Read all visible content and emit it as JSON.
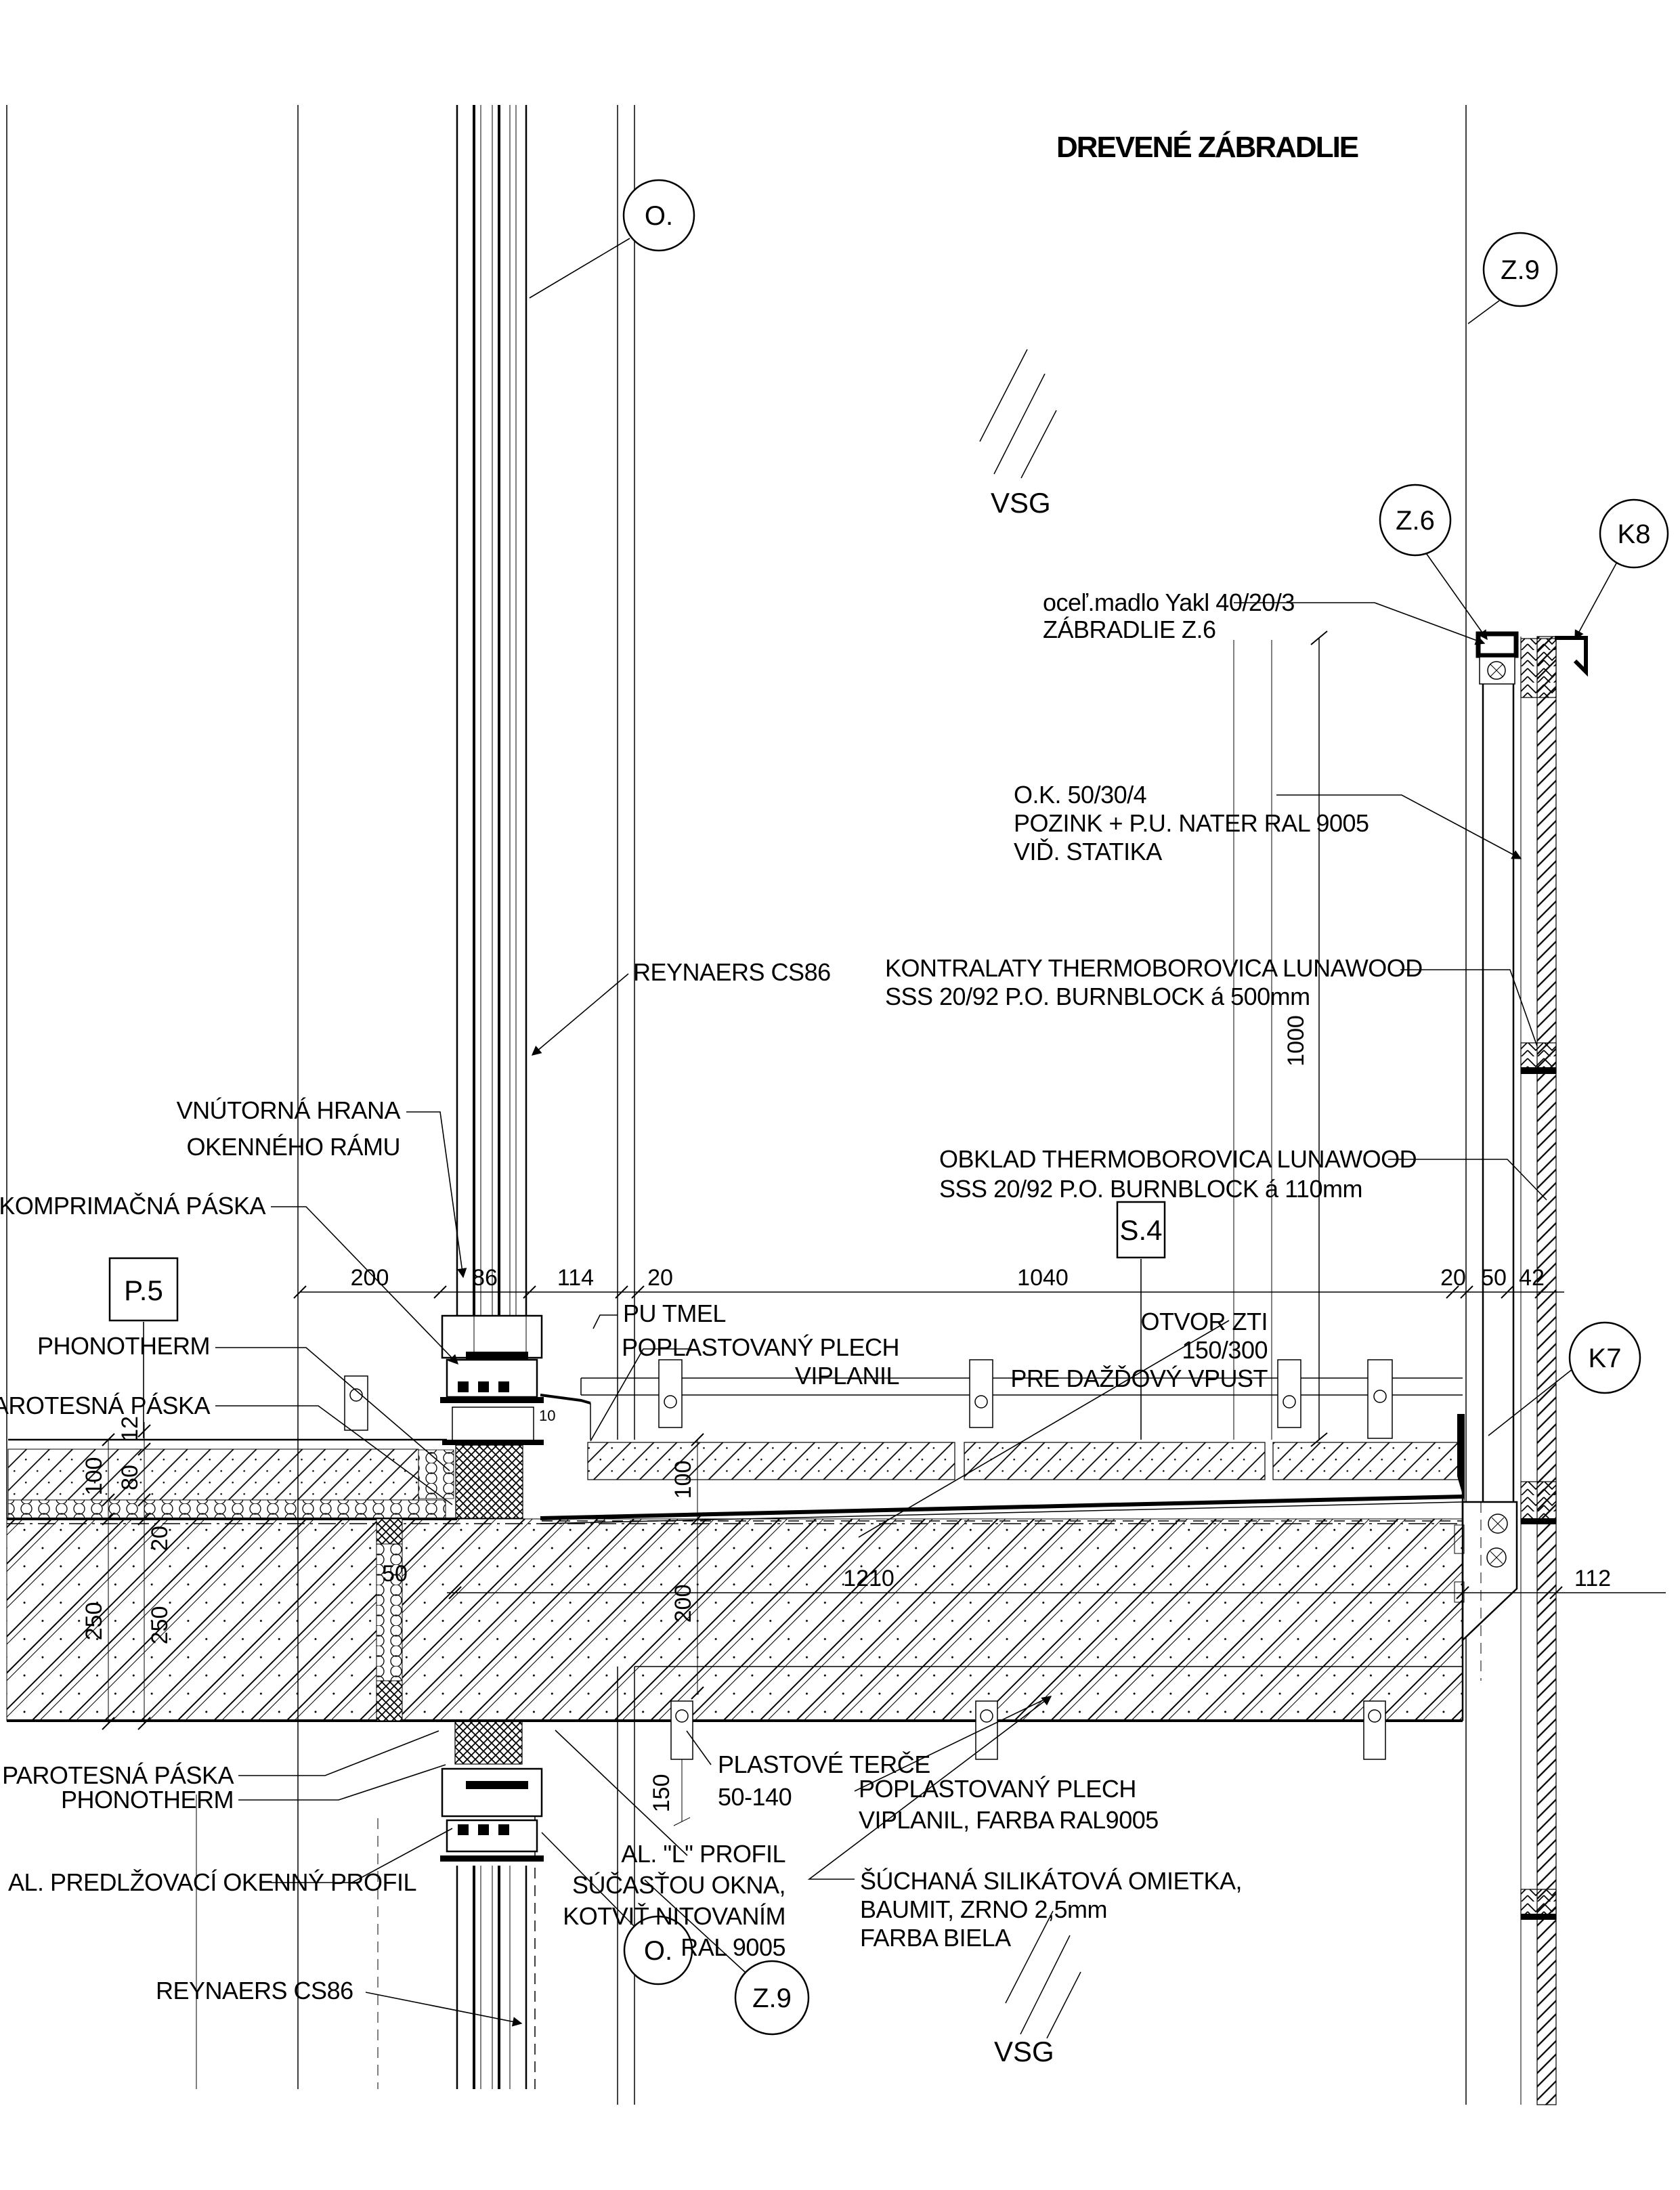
{
  "drawing": {
    "title": "DREVENÉ ZÁBRADLIE",
    "glass_label_top": "VSG",
    "glass_label_bottom": "VSG",
    "callouts": {
      "o_top": "O.",
      "z9_top": "Z.9",
      "z6": "Z.6",
      "k8": "K8",
      "k7": "K7",
      "o_bottom": "O.",
      "z9_bottom": "Z.9"
    },
    "ref_boxes": {
      "p5": "P.5",
      "s4": "S.4"
    },
    "notes": {
      "handrail": [
        "oceľ.madlo Yakl 40/20/3",
        "ZÁBRADLIE Z.6"
      ],
      "steel_post": [
        "O.K.  50/30/4",
        "POZINK + P.U. NATER RAL 9005",
        "VIĎ. STATIKA"
      ],
      "reynaers_top": "REYNAERS CS86",
      "kontralaty": [
        "KONTRALATY THERMOBOROVICA LUNAWOOD",
        "SSS 20/92 P.O. BURNBLOCK á 500mm"
      ],
      "obklad": [
        "OBKLAD THERMOBOROVICA LUNAWOOD",
        "SSS 20/92 P.O. BURNBLOCK á 110mm"
      ],
      "vnutorna": [
        "VNÚTORNÁ HRANA",
        "OKENNÉHO RÁMU"
      ],
      "komprimacna": "KOMPRIMAČNÁ PÁSKA",
      "phonotherm_top": "PHONOTHERM",
      "parotesna_top": "PAROTESNÁ PÁSKA",
      "pu_tmel": "PU TMEL",
      "poplastovany_top": [
        "POPLASTOVANÝ PLECH",
        "VIPLANIL"
      ],
      "otvor": [
        "OTVOR ZTI",
        "150/300",
        "PRE DAŽĎOVÝ VPUST"
      ],
      "plastove": [
        "PLASTOVÉ TERČE",
        "50-140"
      ],
      "poplastovany_bottom": [
        "POPLASTOVANÝ PLECH",
        "VIPLANIL,  FARBA RAL9005"
      ],
      "al_l": [
        "AL. \"L\" PROFIL",
        "SÚČASŤOU OKNA,",
        "KOTVIŤ NITOVANÍM",
        "RAL 9005"
      ],
      "suchana": [
        "ŠÚCHANÁ SILIKÁTOVÁ OMIETKA,",
        "BAUMIT, ZRNO 2,5mm",
        "FARBA BIELA"
      ],
      "parotesna_bottom": [
        "PAROTESNÁ PÁSKA",
        "PHONOTHERM"
      ],
      "al_predlzovaci": "AL. PREDLŽOVACÍ OKENNÝ PROFIL",
      "reynaers_bottom": "REYNAERS CS86"
    },
    "dimensions": {
      "row": [
        "200",
        "86",
        "114",
        "20",
        "1040",
        "20",
        "50",
        "42"
      ],
      "v1000": "1000",
      "d1210": "1210",
      "d112": "112",
      "d150": "150",
      "d100_left": "100",
      "d80": "80",
      "d12": "12",
      "d20_left": "20",
      "d250a": "250",
      "d250b": "250",
      "d50_iso": "50",
      "d100_mid": "100",
      "d200_mid": "200",
      "d10": "10"
    },
    "colors": {
      "ink": "#000000",
      "paper": "#ffffff"
    }
  }
}
